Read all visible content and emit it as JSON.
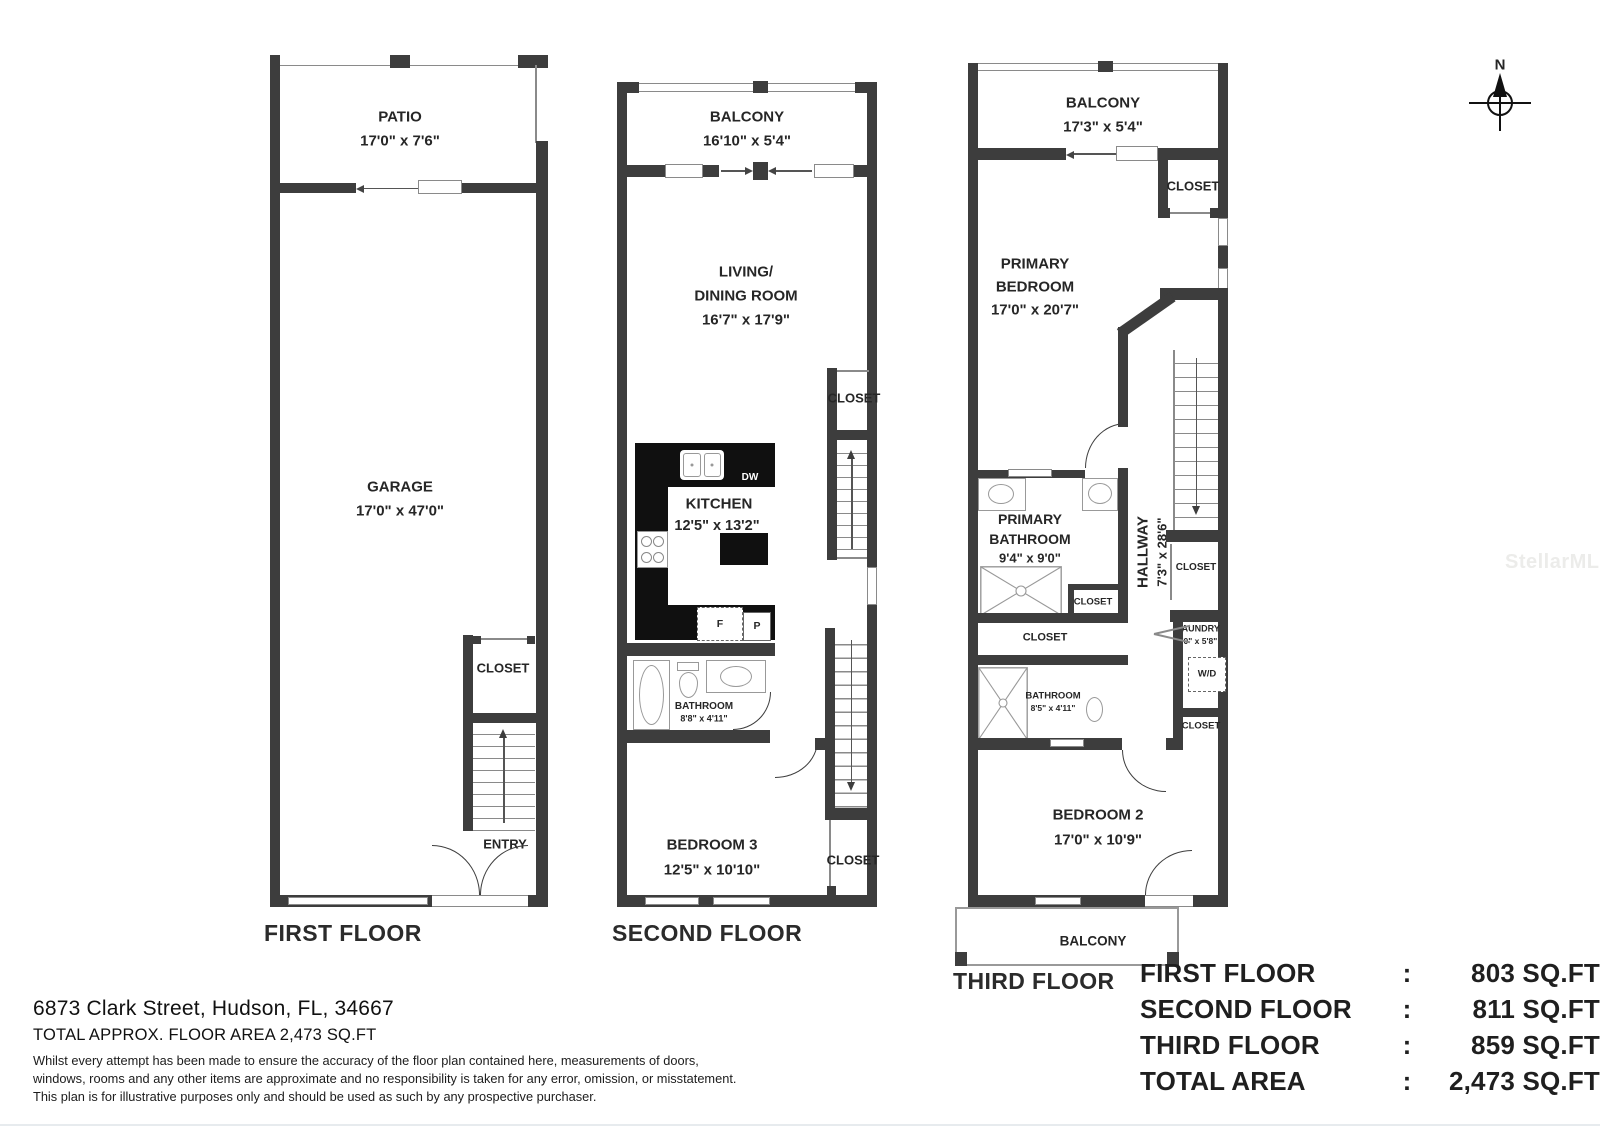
{
  "palette": {
    "wall": "#3d3d3d",
    "counter": "#101010",
    "thin_line": "#8a8a8a",
    "text": "#262626"
  },
  "compass": {
    "north_label": "N"
  },
  "watermark": {
    "text": "StellarMLS"
  },
  "floor1": {
    "label": "FIRST FLOOR",
    "patio_name": "PATIO",
    "patio_dims": "17'0\" x 7'6\"",
    "garage_name": "GARAGE",
    "garage_dims": "17'0\" x 47'0\"",
    "closet": "CLOSET",
    "entry": "ENTRY"
  },
  "floor2": {
    "label": "SECOND FLOOR",
    "balcony_name": "BALCONY",
    "balcony_dims": "16'10\" x 5'4\"",
    "living_line1": "LIVING/",
    "living_line2": "DINING ROOM",
    "living_dims": "16'7\" x 17'9\"",
    "closet_upper": "CLOSET",
    "kitchen_name": "KITCHEN",
    "kitchen_dims": "12'5\" x 13'2\"",
    "dishwasher": "DW",
    "fridge": "F",
    "pantry": "P",
    "bathroom_name": "BATHROOM",
    "bathroom_dims": "8'8\" x 4'11\"",
    "bedroom3_name": "BEDROOM 3",
    "bedroom3_dims": "12'5\" x 10'10\"",
    "closet_lower": "CLOSET"
  },
  "floor3": {
    "label": "THIRD FLOOR",
    "balcony_top_name": "BALCONY",
    "balcony_top_dims": "17'3\" x 5'4\"",
    "closet_top": "CLOSET",
    "primary_bedroom_line1": "PRIMARY",
    "primary_bedroom_line2": "BEDROOM",
    "primary_bedroom_dims": "17'0\" x 20'7\"",
    "primary_bathroom_line1": "PRIMARY",
    "primary_bathroom_line2": "BATHROOM",
    "primary_bathroom_dims": "9'4\" x 9'0\"",
    "hallway_name": "HALLWAY",
    "hallway_dims": "7'3\" x 28'6\"",
    "closet_inner": "CLOSET",
    "closet_mid": "CLOSET",
    "closet_stairs": "CLOSET",
    "laundry_name": "LAUNDRY",
    "laundry_dims": "4'0\" x 5'8\"",
    "washer_dryer": "W/D",
    "bathroom_name": "BATHROOM",
    "bathroom_dims": "8'5\" x 4'11\"",
    "closet_lower": "CLOSET",
    "bedroom2_name": "BEDROOM 2",
    "bedroom2_dims": "17'0\" x 10'9\"",
    "balcony_bottom_name": "BALCONY"
  },
  "summary": {
    "rows": [
      {
        "label": "FIRST FLOOR",
        "sep": ":",
        "value": "803 SQ.FT"
      },
      {
        "label": "SECOND FLOOR",
        "sep": ":",
        "value": "811 SQ.FT"
      },
      {
        "label": "THIRD FLOOR",
        "sep": ":",
        "value": "859 SQ.FT"
      },
      {
        "label": "TOTAL AREA",
        "sep": ":",
        "value": "2,473 SQ.FT"
      }
    ]
  },
  "footer": {
    "address": "6873 Clark Street, Hudson, FL, 34667",
    "total_line": "TOTAL APPROX. FLOOR AREA 2,473 SQ.FT",
    "disclaimer1": "Whilst every attempt has been made to ensure the accuracy of the floor plan contained here, measurements of doors,",
    "disclaimer2": "windows, rooms and any other items are approximate and no responsibility is taken for any error, omission, or misstatement.",
    "disclaimer3": "This plan is for illustrative purposes only and should be used as such by any prospective purchaser."
  }
}
